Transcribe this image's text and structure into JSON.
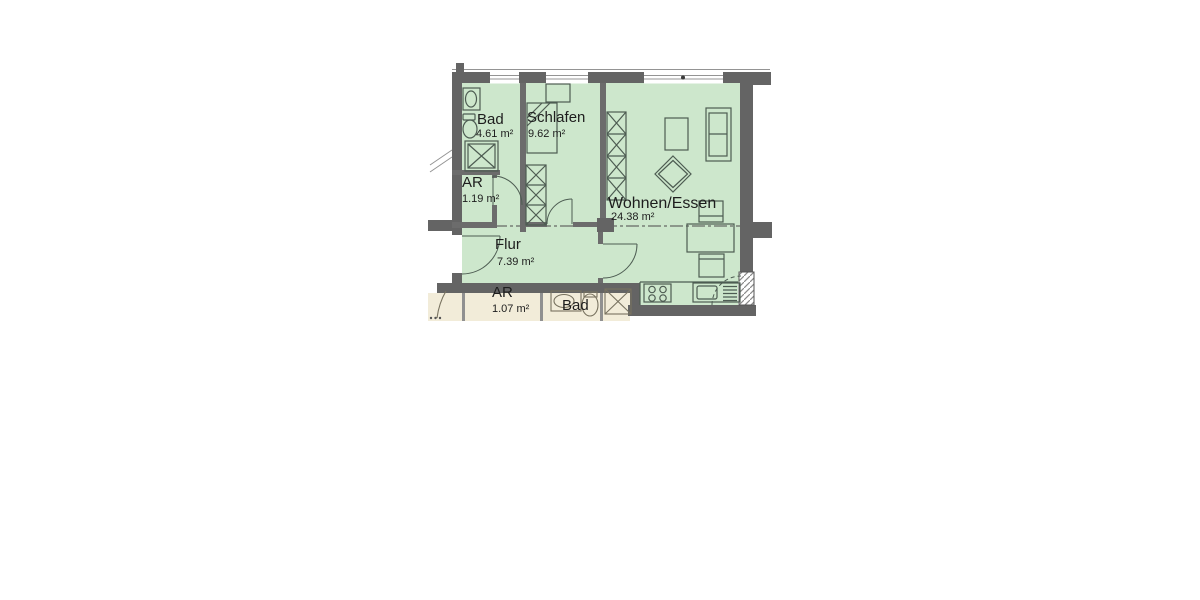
{
  "plan": {
    "rooms": {
      "bad": {
        "name": "Bad",
        "area": "4.61 m²"
      },
      "schlafen": {
        "name": "Schlafen",
        "area": "9.62 m²"
      },
      "ar": {
        "name": "AR",
        "area": "1.19 m²"
      },
      "flur": {
        "name": "Flur",
        "area": "7.39 m²"
      },
      "wohnen": {
        "name": "Wohnen/Essen",
        "area": "24.38 m²"
      },
      "ar2": {
        "name": "AR",
        "area": "1.07 m²"
      },
      "bad2": {
        "name": "Bad"
      }
    },
    "colors": {
      "apartment_floor": "#cde7cc",
      "neighbor_floor": "#f2ecd9",
      "wall": "#646464"
    }
  }
}
